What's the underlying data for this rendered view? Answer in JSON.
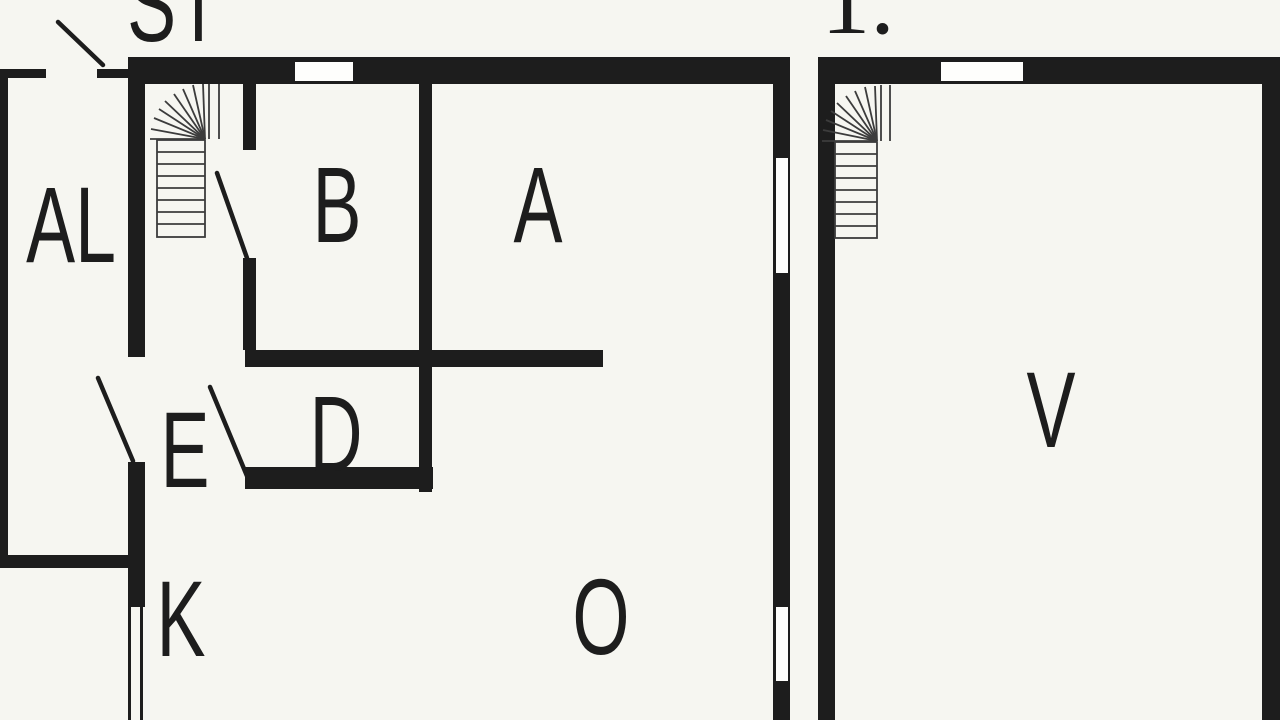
{
  "palette": {
    "background": "#f6f6f1",
    "wall": "#1d1d1d",
    "window": "#fefefc",
    "stair_line": "#3c3c3c",
    "text": "#1d1d1d"
  },
  "plan": {
    "stair_title": "ST",
    "floor_label": "1.",
    "rooms": [
      {
        "id": "al",
        "label": "AL"
      },
      {
        "id": "b",
        "label": "B"
      },
      {
        "id": "a",
        "label": "A"
      },
      {
        "id": "d",
        "label": "D"
      },
      {
        "id": "e",
        "label": "E"
      },
      {
        "id": "k",
        "label": "K"
      },
      {
        "id": "o",
        "label": "O"
      },
      {
        "id": "v",
        "label": "V"
      }
    ],
    "icons": [
      "staircase-icon",
      "door-swing-icon",
      "window-opening"
    ]
  }
}
